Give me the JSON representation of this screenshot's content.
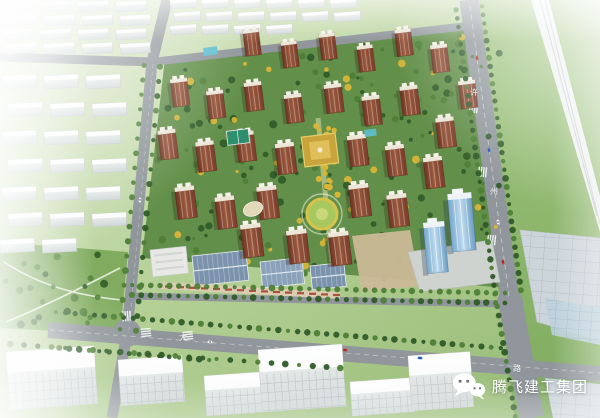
{
  "scene": {
    "type": "aerial architectural rendering",
    "description": "Bird's-eye master-plan rendering of a residential development: rows of red-brick high-rise towers with landscaped courtyards, a commercial street and two blue glass office towers at the south-east corner, surrounded by ghosted white context buildings and green fields"
  },
  "watermark": {
    "icon": "wechat-icon",
    "company_name": "腾飞建工集团"
  },
  "road_labels": [
    {
      "text": "许",
      "x": 474,
      "y": 93,
      "road": "vertical-road"
    },
    {
      "text": "州",
      "x": 494,
      "y": 192,
      "road": "vertical-road"
    },
    {
      "text": "路",
      "x": 517,
      "y": 369,
      "road": "vertical-road"
    },
    {
      "text": "大",
      "x": 183,
      "y": 338,
      "road": "bottom-road"
    }
  ],
  "palette": {
    "field_pale": "#d9e6c4",
    "field_mid": "#aac98a",
    "field_green": "#8fb56d",
    "site_green": "#628f49",
    "park_green": "#7ca85a",
    "road_gray": "#90969b",
    "highway_white": "#edf0f0",
    "pavement": "#ccd5da",
    "pavement_blue": "#bcd0dc",
    "ghost_light": "#f0f2f1",
    "ghost_dark": "#d3d9d9",
    "tower_facade_dark": "#7a3c2a",
    "tower_facade_light": "#9a5a40",
    "tower_roof": "#ece6d8",
    "commercial_roof_blue": "#7b93ad",
    "commercial_wall": "#dccdb2",
    "sign_red": "#a03a2a",
    "glass_light": "#bfdcee",
    "glass_dark": "#76a9cf",
    "tree_dark": "#2f5b28",
    "tree_mid": "#4e7f37",
    "tree_yellow": "#d9b637",
    "water": "#5fc0cf",
    "plaza_gold": "#c9a43c",
    "lawn_ring": "#d6c44a"
  }
}
